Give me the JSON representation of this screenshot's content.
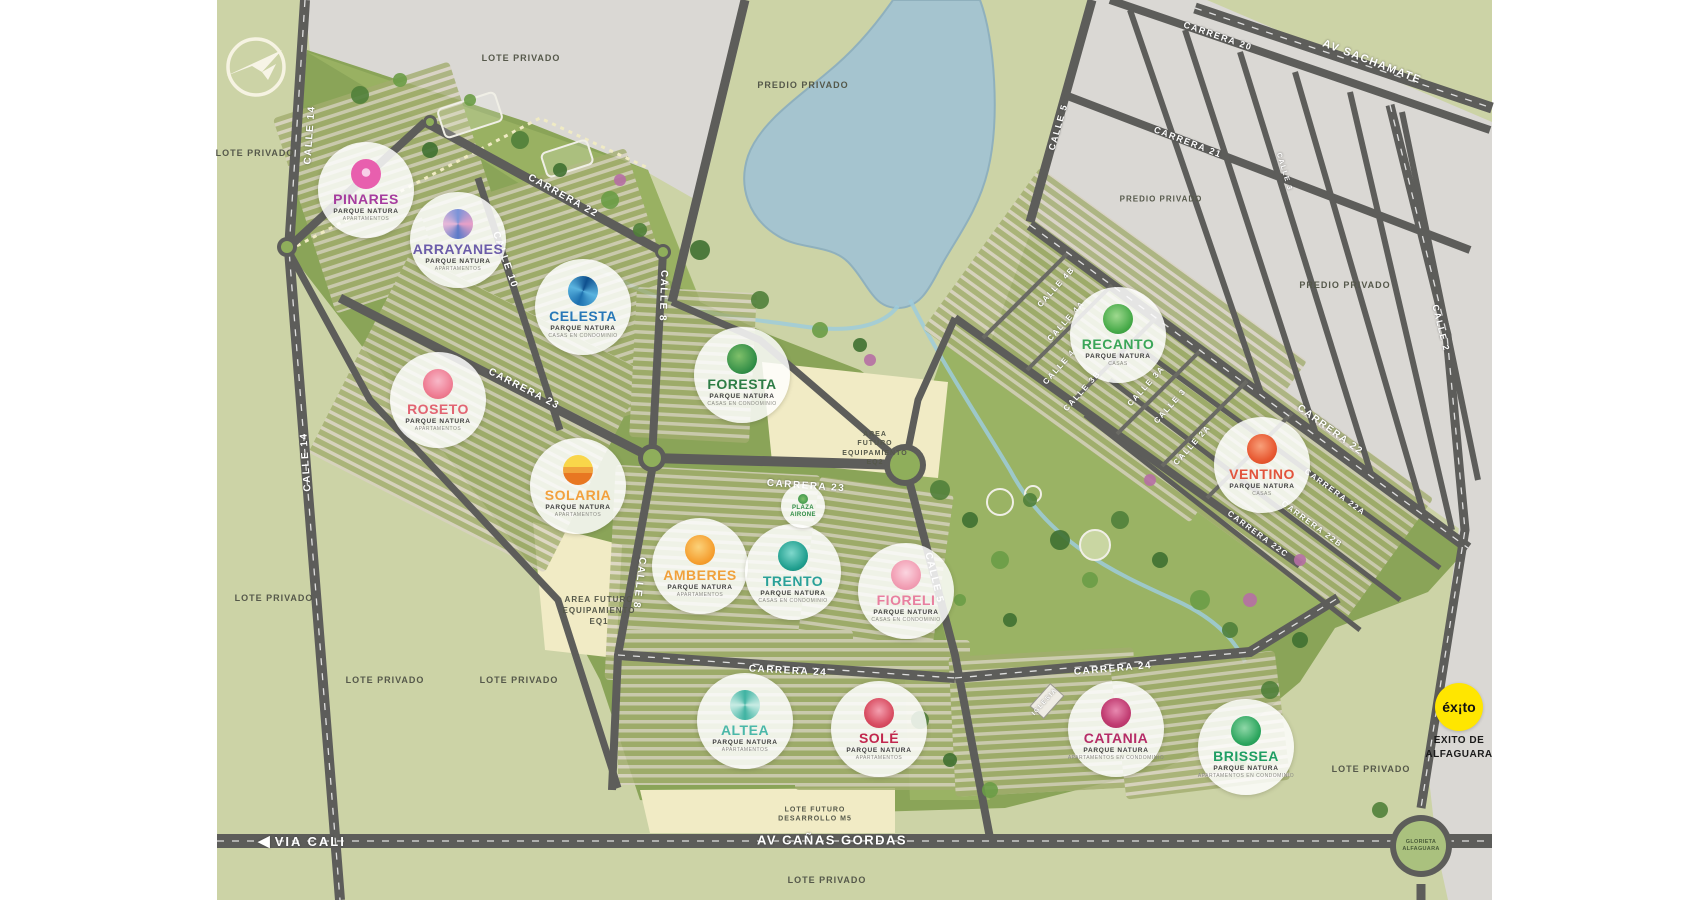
{
  "map": {
    "brand_subtitle": "PARQUE NATURA",
    "projects": [
      {
        "name": "PINARES",
        "subtitle": "PARQUE NATURA",
        "type": "APARTAMENTOS",
        "color": "#a63c9e",
        "icon": "pinares-bloom-icon",
        "x": 366,
        "y": 190
      },
      {
        "name": "ARRAYANES",
        "subtitle": "PARQUE NATURA",
        "type": "APARTAMENTOS",
        "color": "#6b5ca9",
        "icon": "arrayanes-bloom-icon",
        "x": 458,
        "y": 240
      },
      {
        "name": "CELESTA",
        "subtitle": "PARQUE NATURA",
        "type": "CASAS EN CONDOMINIO",
        "color": "#2878b8",
        "icon": "celesta-wave-icon",
        "x": 583,
        "y": 307
      },
      {
        "name": "FORESTA",
        "subtitle": "PARQUE NATURA",
        "type": "CASAS EN CONDOMINIO",
        "color": "#2e7d46",
        "icon": "foresta-leaf-icon",
        "x": 742,
        "y": 375
      },
      {
        "name": "ROSETO",
        "subtitle": "PARQUE NATURA",
        "type": "APARTAMENTOS",
        "color": "#e26472",
        "icon": "roseto-flower-icon",
        "x": 438,
        "y": 400
      },
      {
        "name": "SOLARIA",
        "subtitle": "PARQUE NATURA",
        "type": "APARTAMENTOS",
        "color": "#f2a03d",
        "icon": "solaria-sun-icon",
        "x": 578,
        "y": 486
      },
      {
        "name": "AMBERES",
        "subtitle": "PARQUE NATURA",
        "type": "APARTAMENTOS",
        "color": "#f0a13c",
        "icon": "amberes-bloom-icon",
        "x": 700,
        "y": 566
      },
      {
        "name": "TRENTO",
        "subtitle": "PARQUE NATURA",
        "type": "CASAS EN CONDOMINIO",
        "color": "#2aa199",
        "icon": "trento-cone-icon",
        "x": 793,
        "y": 572
      },
      {
        "name": "FIORELI",
        "subtitle": "PARQUE NATURA",
        "type": "CASAS EN CONDOMINIO",
        "color": "#e87f9f",
        "icon": "fioreli-flower-icon",
        "x": 906,
        "y": 591
      },
      {
        "name": "RECANTO",
        "subtitle": "PARQUE NATURA",
        "type": "CASAS",
        "color": "#3aa558",
        "icon": "recanto-leaf-icon",
        "x": 1118,
        "y": 335
      },
      {
        "name": "VENTINO",
        "subtitle": "PARQUE NATURA",
        "type": "CASAS",
        "color": "#e2543c",
        "icon": "ventino-bloom-icon",
        "x": 1262,
        "y": 465
      },
      {
        "name": "ALTEA",
        "subtitle": "PARQUE NATURA",
        "type": "APARTAMENTOS",
        "color": "#4bb8a9",
        "icon": "altea-spiral-icon",
        "x": 745,
        "y": 721
      },
      {
        "name": "SOLÉ",
        "subtitle": "PARQUE NATURA",
        "type": "APARTAMENTOS",
        "color": "#c2274e",
        "icon": "sole-flower-icon",
        "x": 879,
        "y": 729
      },
      {
        "name": "CATANIA",
        "subtitle": "PARQUE NATURA",
        "type": "APARTAMENTOS EN CONDOMINIO",
        "color": "#b62d67",
        "icon": "catania-rose-icon",
        "x": 1116,
        "y": 729
      },
      {
        "name": "BRISSEA",
        "subtitle": "PARQUE NATURA",
        "type": "APARTAMENTOS EN CONDOMINIO",
        "color": "#1f9e63",
        "icon": "brissea-tree-icon",
        "x": 1246,
        "y": 747
      }
    ],
    "plaza": {
      "line1": "PLAZA",
      "line2": "AIRONE",
      "color": "#2e8b45",
      "x": 803,
      "y": 506
    },
    "street_labels": [
      {
        "text": "CALLE 14",
        "x": 310,
        "y": 135,
        "rot": -86,
        "size": 10
      },
      {
        "text": "CALLE 14",
        "x": 306,
        "y": 462,
        "rot": -94,
        "size": 10
      },
      {
        "text": "CARRERA 22",
        "x": 563,
        "y": 196,
        "rot": 29,
        "size": 10
      },
      {
        "text": "CALLE 10",
        "x": 505,
        "y": 260,
        "rot": 71,
        "size": 10
      },
      {
        "text": "CALLE 8",
        "x": 663,
        "y": 296,
        "rot": 92,
        "size": 10
      },
      {
        "text": "CARRERA 23",
        "x": 524,
        "y": 389,
        "rot": 27,
        "size": 10
      },
      {
        "text": "CARRERA 23",
        "x": 806,
        "y": 486,
        "rot": 4,
        "size": 10
      },
      {
        "text": "CALLE 8",
        "x": 639,
        "y": 583,
        "rot": 97,
        "size": 10
      },
      {
        "text": "CARRERA 24",
        "x": 788,
        "y": 671,
        "rot": 3,
        "size": 10
      },
      {
        "text": "CARRERA 24",
        "x": 1113,
        "y": 669,
        "rot": -5,
        "size": 10
      },
      {
        "text": "CALLE 5",
        "x": 934,
        "y": 578,
        "rot": 76,
        "size": 10
      },
      {
        "text": "CALLE 4B",
        "x": 1056,
        "y": 287,
        "rot": -48,
        "size": 8
      },
      {
        "text": "CALLE 4A",
        "x": 1066,
        "y": 321,
        "rot": -48,
        "size": 8
      },
      {
        "text": "CALLE 4",
        "x": 1059,
        "y": 367,
        "rot": -48,
        "size": 8
      },
      {
        "text": "CALLE 3B",
        "x": 1082,
        "y": 391,
        "rot": -48,
        "size": 8
      },
      {
        "text": "CALLE 3A",
        "x": 1146,
        "y": 386,
        "rot": -48,
        "size": 8
      },
      {
        "text": "CALLE 3",
        "x": 1170,
        "y": 406,
        "rot": -48,
        "size": 8
      },
      {
        "text": "CALLE 2A",
        "x": 1192,
        "y": 445,
        "rot": -48,
        "size": 8
      },
      {
        "text": "CARRERA 22",
        "x": 1330,
        "y": 430,
        "rot": 36,
        "size": 10
      },
      {
        "text": "CARRERA 22A",
        "x": 1335,
        "y": 492,
        "rot": 36,
        "size": 8
      },
      {
        "text": "CARRERA 22B",
        "x": 1312,
        "y": 524,
        "rot": 36,
        "size": 8
      },
      {
        "text": "CARRERA 22C",
        "x": 1258,
        "y": 534,
        "rot": 36,
        "size": 8
      },
      {
        "text": "CALLE 5",
        "x": 1058,
        "y": 127,
        "rot": -74,
        "size": 9
      },
      {
        "text": "CARRERA 20",
        "x": 1218,
        "y": 36,
        "rot": 19,
        "size": 9
      },
      {
        "text": "CARRERA 21",
        "x": 1188,
        "y": 142,
        "rot": 21,
        "size": 9
      },
      {
        "text": "CALLE 3",
        "x": 1284,
        "y": 172,
        "rot": 73,
        "size": 7
      },
      {
        "text": "AV SACHAMATE",
        "x": 1372,
        "y": 62,
        "rot": 21,
        "size": 11
      },
      {
        "text": "CALLE 2",
        "x": 1441,
        "y": 328,
        "rot": 76,
        "size": 9
      },
      {
        "text": "AV CAÑAS GORDAS",
        "x": 832,
        "y": 840,
        "rot": 0,
        "size": 13
      },
      {
        "text": "IGLESIA",
        "x": 1045,
        "y": 702,
        "rot": -48,
        "size": 6
      }
    ],
    "area_labels": [
      {
        "lines": [
          "LOTE PRIVADO"
        ],
        "x": 521,
        "y": 58,
        "size": 9
      },
      {
        "lines": [
          "LOTE PRIVADO"
        ],
        "x": 255,
        "y": 153,
        "size": 9
      },
      {
        "lines": [
          "LOTE PRIVADO"
        ],
        "x": 274,
        "y": 598,
        "size": 9
      },
      {
        "lines": [
          "LOTE PRIVADO"
        ],
        "x": 385,
        "y": 680,
        "size": 9
      },
      {
        "lines": [
          "LOTE PRIVADO"
        ],
        "x": 519,
        "y": 680,
        "size": 9
      },
      {
        "lines": [
          "LOTE PRIVADO"
        ],
        "x": 827,
        "y": 880,
        "size": 9
      },
      {
        "lines": [
          "LOTE PRIVADO"
        ],
        "x": 1371,
        "y": 769,
        "size": 9
      },
      {
        "lines": [
          "PREDIO PRIVADO"
        ],
        "x": 803,
        "y": 85,
        "size": 9
      },
      {
        "lines": [
          "PREDIO PRIVADO"
        ],
        "x": 1161,
        "y": 200,
        "size": 8
      },
      {
        "lines": [
          "PREDIO PRIVADO"
        ],
        "x": 1345,
        "y": 285,
        "size": 9
      },
      {
        "lines": [
          "AREA FUTURO",
          "EQUIPAMIENTO",
          "EQ1"
        ],
        "x": 599,
        "y": 611,
        "size": 8
      },
      {
        "lines": [
          "ÁREA",
          "FUTURO",
          "EQUIPAMIENTO",
          "EQ2"
        ],
        "x": 875,
        "y": 449,
        "size": 7
      },
      {
        "lines": [
          "LOTE FUTURO",
          "DESARROLLO M5"
        ],
        "x": 815,
        "y": 815,
        "size": 7
      }
    ],
    "landmarks": {
      "exito": {
        "logo_text": "éx¡to",
        "caption_lines": [
          "EXITO DE",
          "ALFAGUARA"
        ],
        "bg_color": "#ffe600",
        "x": 1459,
        "y": 707
      },
      "glorieta": {
        "lines": [
          "GLORIETA",
          "ALFAGUARA"
        ],
        "x": 1421,
        "y": 846
      },
      "via_cali": {
        "text": "VIA CALI",
        "arrow": "left",
        "x": 302,
        "y": 841
      },
      "developer_logo": {
        "icon": "paper-plane-bird-logo",
        "x": 256,
        "y": 67
      }
    }
  }
}
